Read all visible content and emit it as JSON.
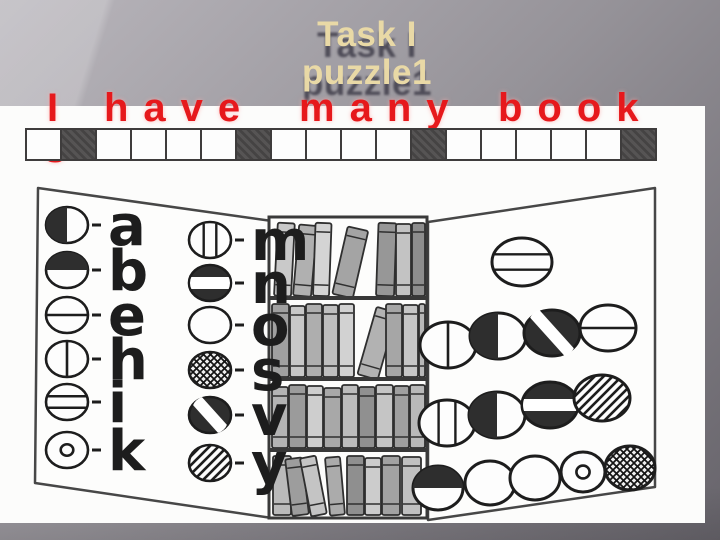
{
  "slide": {
    "title": {
      "line1": "Task I",
      "line2": "puzzle1"
    },
    "sentence": {
      "words": [
        "I",
        "have",
        "many",
        "book"
      ],
      "wrap": "s",
      "full_text": "I have many books"
    },
    "colors": {
      "title_text": "#e9d9a6",
      "title_shadow": "#49464f",
      "sentence_red": "#e6191c",
      "background_light": "#b9b6bc",
      "background_dark": "#67646b",
      "ink": "#1d1d1d"
    }
  },
  "strip": {
    "cells": [
      "white",
      "black",
      "white",
      "white",
      "white",
      "white",
      "black",
      "white",
      "white",
      "white",
      "white",
      "black",
      "white",
      "white",
      "white",
      "white",
      "white",
      "black"
    ]
  },
  "puzzle": {
    "illustration": "open-book-with-bookshelf-drawing",
    "legend": {
      "column1": [
        {
          "symbol": "left-half-filled",
          "letter": "a"
        },
        {
          "symbol": "top-half-filled",
          "letter": "b"
        },
        {
          "symbol": "horizontal-line",
          "letter": "e"
        },
        {
          "symbol": "vertical-line",
          "letter": "h"
        },
        {
          "symbol": "horizontal-band",
          "letter": "i"
        },
        {
          "symbol": "inner-dot",
          "letter": "k"
        }
      ],
      "column2": [
        {
          "symbol": "vertical-band",
          "letter": "m"
        },
        {
          "symbol": "filled-white-hstripe",
          "letter": "n"
        },
        {
          "symbol": "empty",
          "letter": "o"
        },
        {
          "symbol": "crosshatch",
          "letter": "s"
        },
        {
          "symbol": "filled-white-dstripe",
          "letter": "v"
        },
        {
          "symbol": "diagonal-hatch",
          "letter": "y"
        }
      ]
    },
    "rows": [
      [
        "horizontal-band"
      ],
      [
        "vertical-line",
        "left-half-filled",
        "filled-white-dstripe",
        "horizontal-line"
      ],
      [
        "vertical-band",
        "left-half-filled",
        "filled-white-hstripe",
        "diagonal-hatch"
      ],
      [
        "top-half-filled",
        "empty",
        "empty",
        "inner-dot",
        "crosshatch"
      ]
    ]
  }
}
